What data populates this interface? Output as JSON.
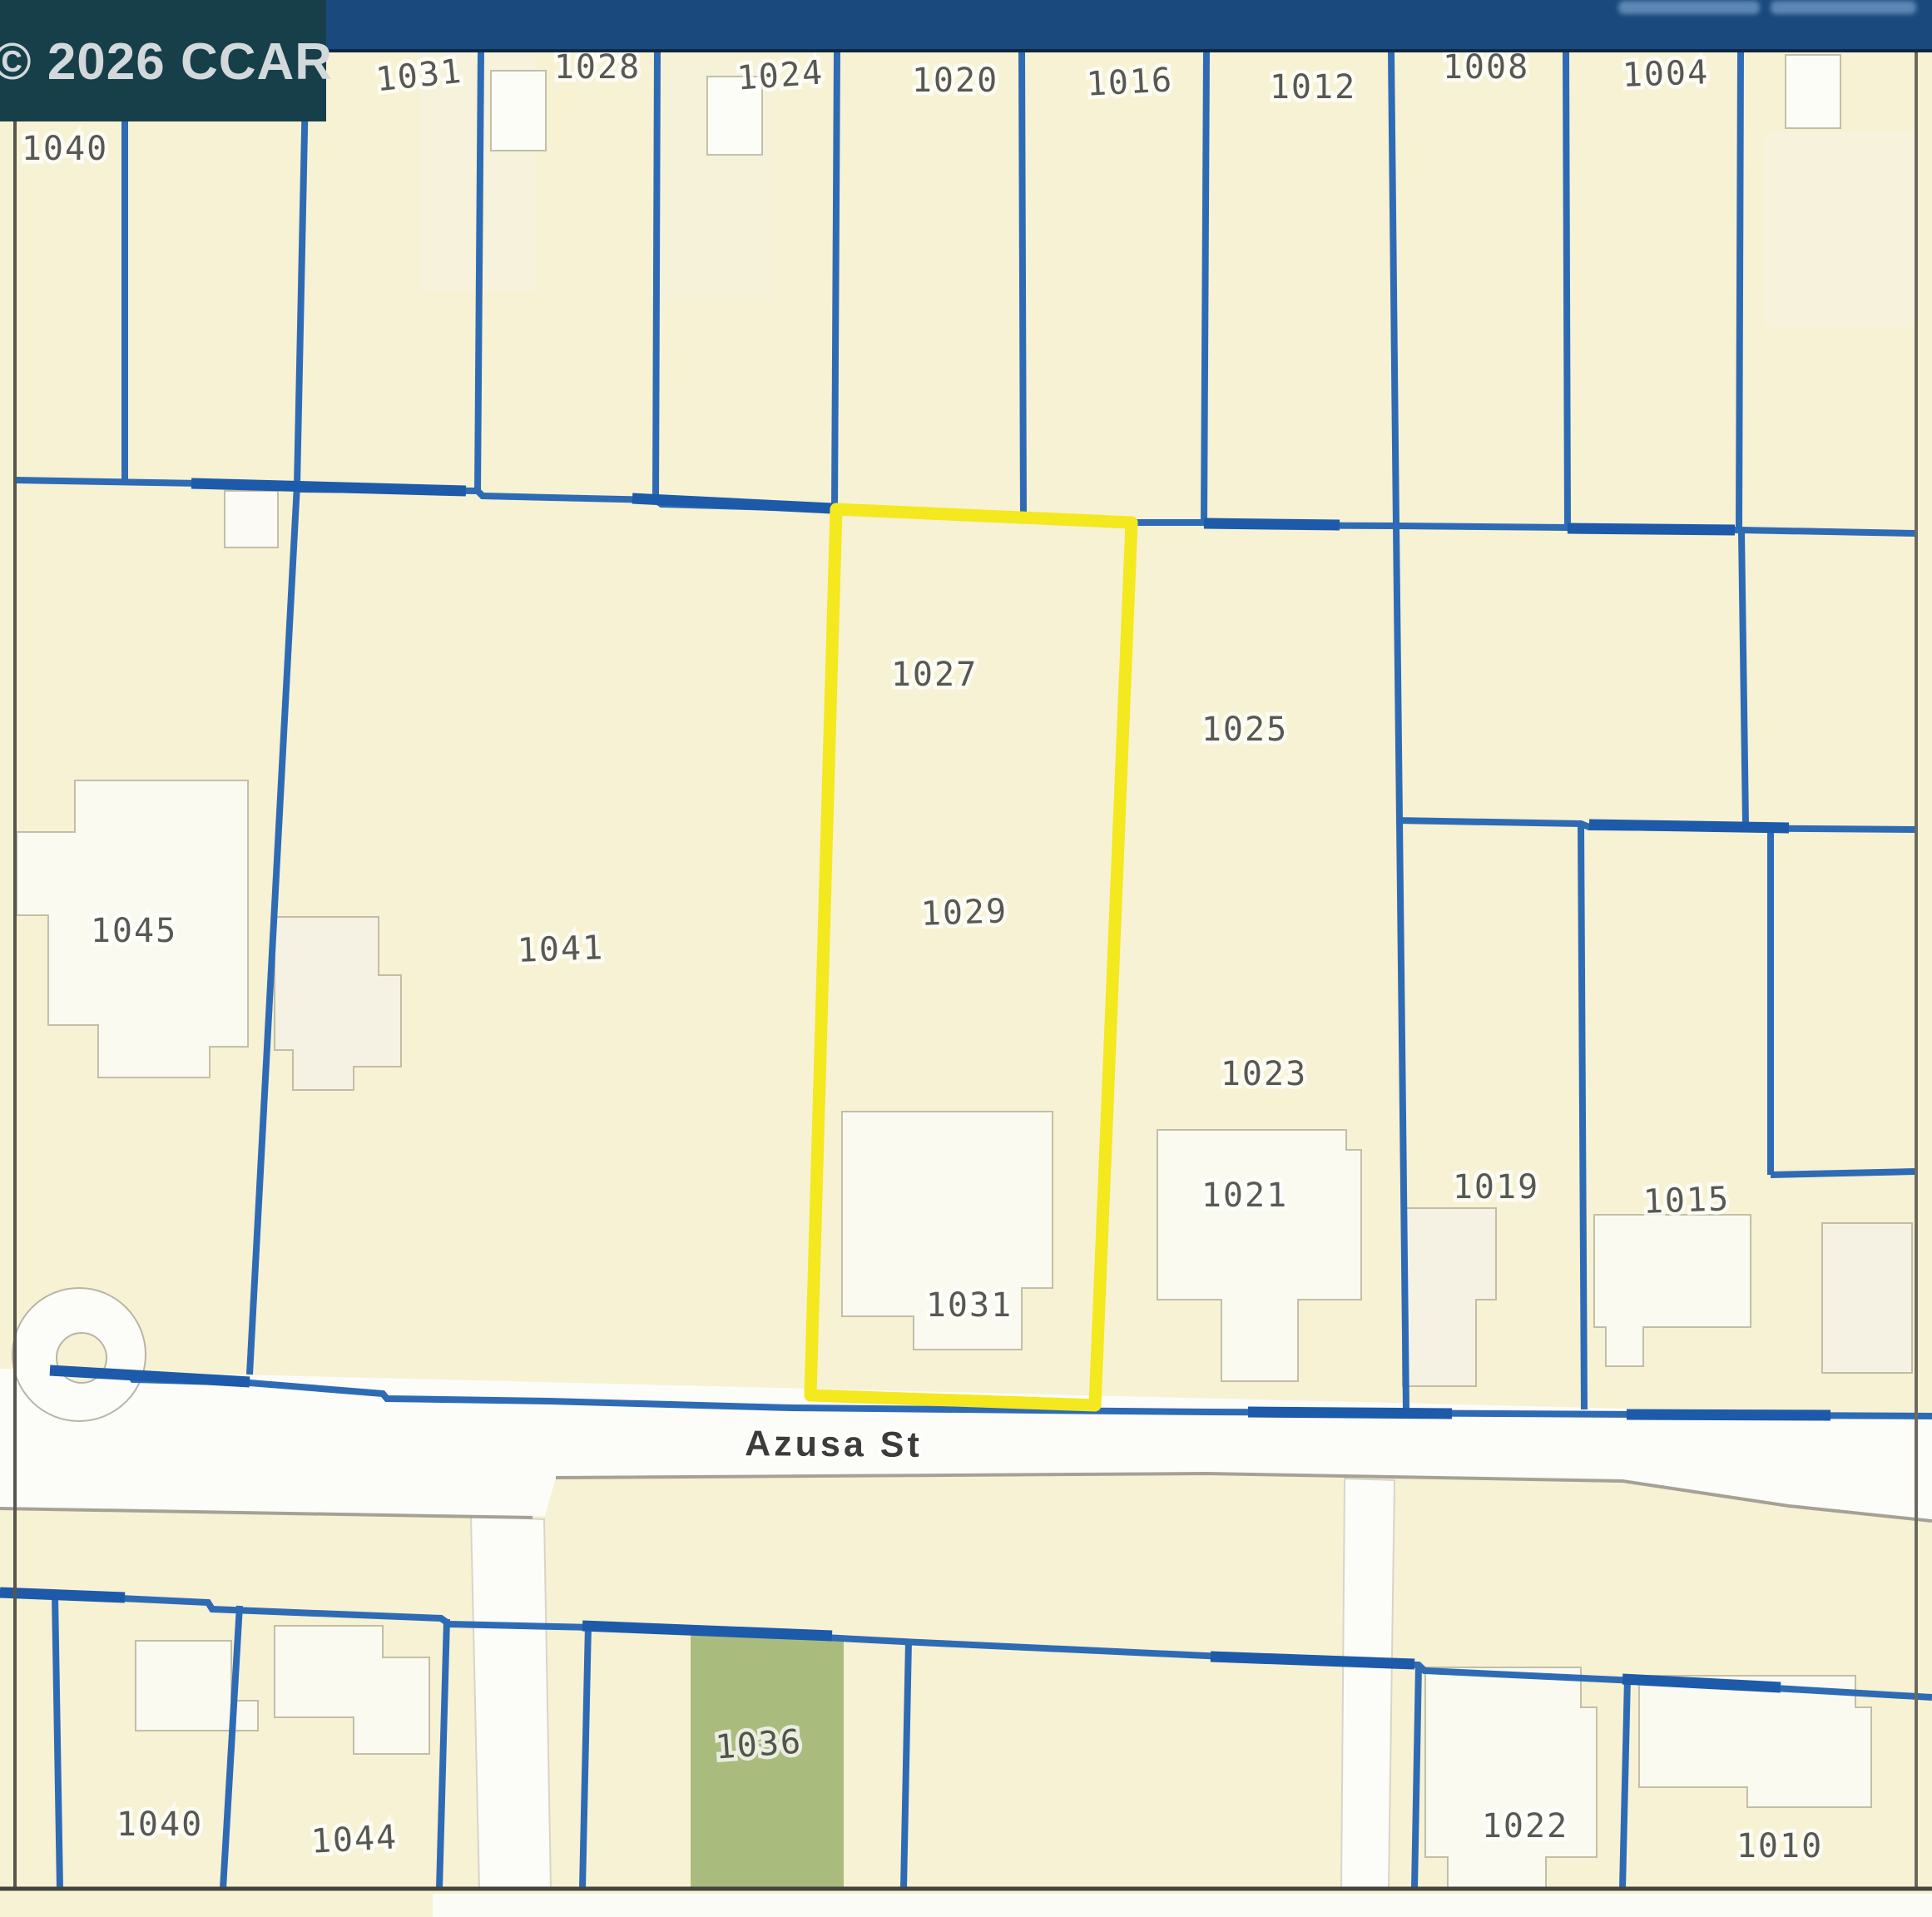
{
  "copyright_badge": {
    "text": "© 2026 CCAR"
  },
  "top_bar": {
    "note_text": ""
  },
  "street": {
    "label": "Azusa St"
  },
  "highlight": {
    "parcels": [
      "1027",
      "1029",
      "1031"
    ],
    "color": "#f4e81f"
  },
  "labels": [
    {
      "text": "1040"
    },
    {
      "text": "1031"
    },
    {
      "text": "1028"
    },
    {
      "text": "1024"
    },
    {
      "text": "1020"
    },
    {
      "text": "1016"
    },
    {
      "text": "1012"
    },
    {
      "text": "1008"
    },
    {
      "text": "1004"
    },
    {
      "text": "1045"
    },
    {
      "text": "1041"
    },
    {
      "text": "1027"
    },
    {
      "text": "1029"
    },
    {
      "text": "1031"
    },
    {
      "text": "1025"
    },
    {
      "text": "1023"
    },
    {
      "text": "1021"
    },
    {
      "text": "1019"
    },
    {
      "text": "1015"
    },
    {
      "text": "1040"
    },
    {
      "text": "1044"
    },
    {
      "text": "1036"
    },
    {
      "text": "1022"
    },
    {
      "text": "1010"
    }
  ],
  "colors": {
    "parcel_line": "#2e6bb4",
    "parcel_line_bold": "#1d5aa9",
    "highlight": "#f4e81f",
    "map_background": "#f7f2d4",
    "street_fill": "#fcfcf9",
    "green_parcel": "#a9bc7e",
    "building_fill": "#f5f2e4",
    "top_bar": "#1a4a7d",
    "badge_background": "#173f4a"
  }
}
